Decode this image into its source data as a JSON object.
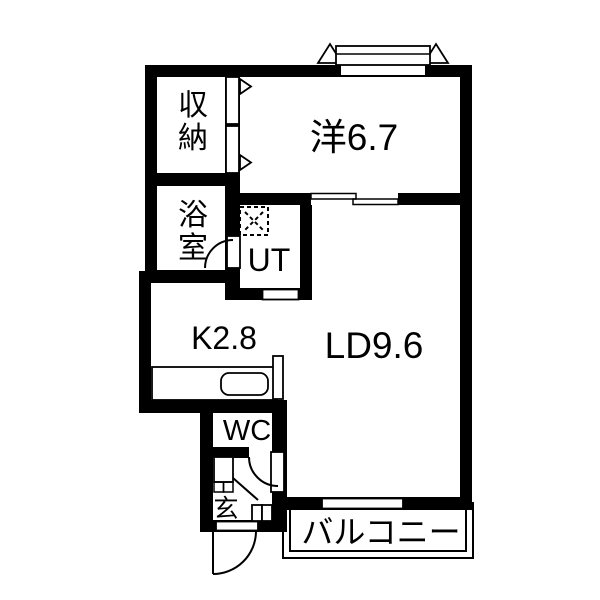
{
  "plan": {
    "background_color": "#ffffff",
    "line_color": "#000000",
    "rooms": {
      "storage": {
        "label": "収納"
      },
      "western_room": {
        "label": "洋6.7"
      },
      "bath": {
        "label": "浴室"
      },
      "utility": {
        "label": "UT"
      },
      "kitchen": {
        "label": "K2.8"
      },
      "living_dining": {
        "label": "LD9.6"
      },
      "toilet": {
        "label": "WC"
      },
      "entrance": {
        "label": "玄"
      },
      "balcony": {
        "label": "バルコニー"
      }
    }
  }
}
